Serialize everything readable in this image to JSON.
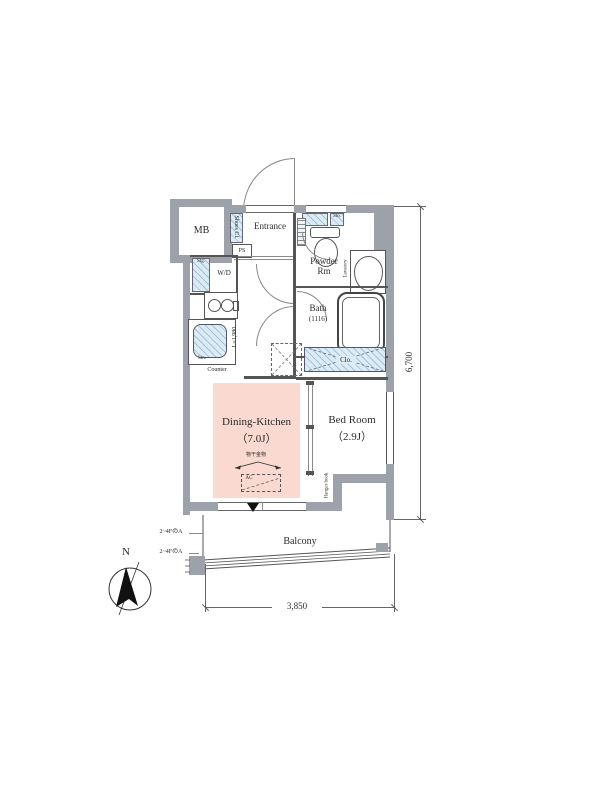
{
  "rooms": {
    "mb": {
      "label": "MB"
    },
    "entrance": {
      "label": "Entrance"
    },
    "powder": {
      "line1": "Powder",
      "line2": "Rm"
    },
    "bath": {
      "label": "Bath",
      "size": "(1116)"
    },
    "wd": {
      "label": "W/D"
    },
    "dk": {
      "label": "Dining-Kitchen",
      "size": "（7.0J）"
    },
    "bedroom": {
      "label": "Bed Room",
      "size": "（2.9J）"
    },
    "balcony": {
      "label": "Balcony"
    }
  },
  "fixtures": {
    "shoes_closet": "Shoes Cl.",
    "ps": "PS",
    "storage": "Stg.",
    "shelf": "Sto.",
    "lavatory": "Lavatory",
    "closet": "Clo.",
    "counter": "Counter",
    "sink": "Sin.",
    "kitchen_length": "L=1,980"
  },
  "annotations": {
    "laundry_hw": "物干金物",
    "ac": "AC",
    "hanger_hook": "Hanger hook",
    "floor_note_1": "2~4FのA",
    "floor_note_2": "2~4FのA"
  },
  "dimensions": {
    "height": "6,700",
    "width": "3,850"
  },
  "compass": {
    "north": "N"
  },
  "colors": {
    "wall": "#9da1a9",
    "fixture_blue": "#dcecf5",
    "room_pink": "#f9d9d0",
    "line": "#555555"
  }
}
